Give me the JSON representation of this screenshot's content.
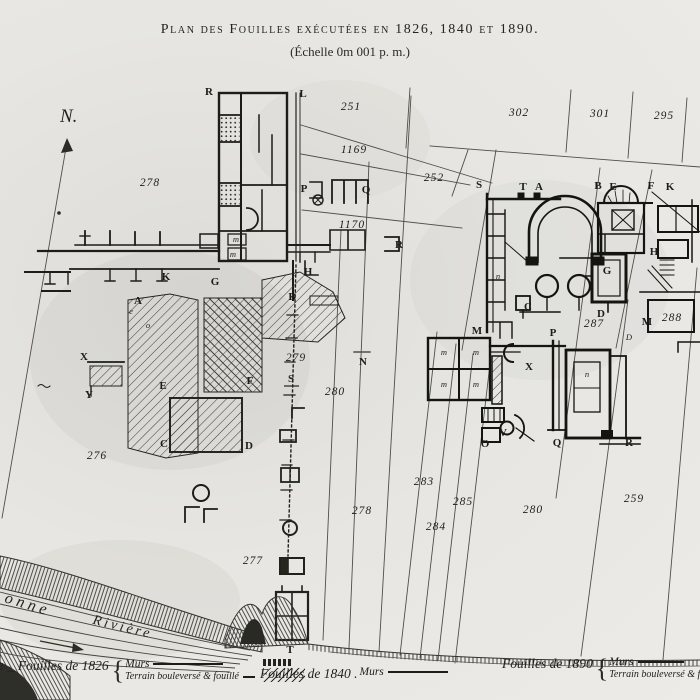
{
  "title": "Plan des Fouilles exécutées en 1826, 1840 et 1890.",
  "subtitle": "(Échelle 0m 001 p. m.)",
  "compass_label": "N.",
  "river": {
    "name_upper": "onne",
    "name_lower": "Rivière"
  },
  "legend": {
    "e1826": {
      "lead": "e _",
      "title": "Fouilles de 1826",
      "murs": "Murs",
      "terrain": "Terrain bouleversé & fouillé"
    },
    "e1840": {
      "title": "Fouilles de 1840 .",
      "murs": "Murs"
    },
    "e1890": {
      "title": "Fouilles de 1890",
      "murs": "Murs",
      "terrain": "Terrain bouleversé & fouillé"
    }
  },
  "colors": {
    "paper": "#e7e6e2",
    "ink": "#1c1c18",
    "parcel_line": "#4f4f4a"
  },
  "map_labels": [
    {
      "t": "278",
      "x": 150,
      "y": 183,
      "c": "n"
    },
    {
      "t": "251",
      "x": 351,
      "y": 107,
      "c": "n"
    },
    {
      "t": "1169",
      "x": 354,
      "y": 150,
      "c": "n"
    },
    {
      "t": "252",
      "x": 434,
      "y": 178,
      "c": "n"
    },
    {
      "t": "1170",
      "x": 352,
      "y": 225,
      "c": "n"
    },
    {
      "t": "302",
      "x": 519,
      "y": 113,
      "c": "n"
    },
    {
      "t": "301",
      "x": 600,
      "y": 114,
      "c": "n"
    },
    {
      "t": "295",
      "x": 664,
      "y": 116,
      "c": "n"
    },
    {
      "t": "279",
      "x": 296,
      "y": 358,
      "c": "n"
    },
    {
      "t": "280",
      "x": 335,
      "y": 392,
      "c": "n"
    },
    {
      "t": "276",
      "x": 97,
      "y": 456,
      "c": "n"
    },
    {
      "t": "277",
      "x": 253,
      "y": 561,
      "c": "n"
    },
    {
      "t": "278",
      "x": 362,
      "y": 511,
      "c": "n"
    },
    {
      "t": "283",
      "x": 424,
      "y": 482,
      "c": "n"
    },
    {
      "t": "285",
      "x": 463,
      "y": 502,
      "c": "n"
    },
    {
      "t": "284",
      "x": 436,
      "y": 527,
      "c": "n"
    },
    {
      "t": "280",
      "x": 533,
      "y": 510,
      "c": "n"
    },
    {
      "t": "259",
      "x": 634,
      "y": 499,
      "c": "n"
    },
    {
      "t": "287",
      "x": 594,
      "y": 324,
      "c": "n"
    },
    {
      "t": "288",
      "x": 672,
      "y": 318,
      "c": "n"
    },
    {
      "t": "R",
      "x": 209,
      "y": 92,
      "c": "L"
    },
    {
      "t": "L",
      "x": 303,
      "y": 94,
      "c": "L"
    },
    {
      "t": "P",
      "x": 304,
      "y": 189,
      "c": "L"
    },
    {
      "t": "Q",
      "x": 366,
      "y": 190,
      "c": "L"
    },
    {
      "t": "R",
      "x": 399,
      "y": 245,
      "c": "L"
    },
    {
      "t": "K",
      "x": 166,
      "y": 277,
      "c": "L"
    },
    {
      "t": "G",
      "x": 215,
      "y": 282,
      "c": "L"
    },
    {
      "t": "A",
      "x": 138,
      "y": 301,
      "c": "L"
    },
    {
      "t": "B",
      "x": 292,
      "y": 297,
      "c": "L"
    },
    {
      "t": "H",
      "x": 308,
      "y": 272,
      "c": "L"
    },
    {
      "t": "E",
      "x": 163,
      "y": 386,
      "c": "L"
    },
    {
      "t": "F",
      "x": 250,
      "y": 381,
      "c": "L"
    },
    {
      "t": "S",
      "x": 291,
      "y": 379,
      "c": "L"
    },
    {
      "t": "C",
      "x": 164,
      "y": 444,
      "c": "L"
    },
    {
      "t": "D",
      "x": 249,
      "y": 446,
      "c": "L"
    },
    {
      "t": "X",
      "x": 84,
      "y": 357,
      "c": "L"
    },
    {
      "t": "Y",
      "x": 89,
      "y": 395,
      "c": "L"
    },
    {
      "t": "T",
      "x": 290,
      "y": 650,
      "c": "L"
    },
    {
      "t": "S",
      "x": 479,
      "y": 185,
      "c": "L"
    },
    {
      "t": "T",
      "x": 523,
      "y": 187,
      "c": "L"
    },
    {
      "t": "A",
      "x": 539,
      "y": 187,
      "c": "L"
    },
    {
      "t": "B",
      "x": 598,
      "y": 186,
      "c": "L"
    },
    {
      "t": "E",
      "x": 613,
      "y": 187,
      "c": "L"
    },
    {
      "t": "F",
      "x": 651,
      "y": 186,
      "c": "L"
    },
    {
      "t": "K",
      "x": 670,
      "y": 187,
      "c": "L"
    },
    {
      "t": "G",
      "x": 607,
      "y": 271,
      "c": "L"
    },
    {
      "t": "H",
      "x": 654,
      "y": 252,
      "c": "L"
    },
    {
      "t": "C",
      "x": 528,
      "y": 307,
      "c": "L"
    },
    {
      "t": "D",
      "x": 601,
      "y": 314,
      "c": "L"
    },
    {
      "t": "M",
      "x": 647,
      "y": 322,
      "c": "L"
    },
    {
      "t": "M",
      "x": 477,
      "y": 331,
      "c": "L"
    },
    {
      "t": "P",
      "x": 553,
      "y": 333,
      "c": "L"
    },
    {
      "t": "X",
      "x": 529,
      "y": 367,
      "c": "L"
    },
    {
      "t": "O",
      "x": 485,
      "y": 444,
      "c": "L"
    },
    {
      "t": "V",
      "x": 503,
      "y": 433,
      "c": "L"
    },
    {
      "t": "Q",
      "x": 557,
      "y": 443,
      "c": "L"
    },
    {
      "t": "R",
      "x": 629,
      "y": 443,
      "c": "L"
    },
    {
      "t": "N",
      "x": 363,
      "y": 362,
      "c": "L"
    },
    {
      "t": "e",
      "x": 131,
      "y": 311,
      "c": "s"
    },
    {
      "t": "o",
      "x": 148,
      "y": 325,
      "c": "s"
    },
    {
      "t": "m",
      "x": 236,
      "y": 239,
      "c": "s"
    },
    {
      "t": "m",
      "x": 233,
      "y": 254,
      "c": "s"
    },
    {
      "t": "n",
      "x": 498,
      "y": 276,
      "c": "s"
    },
    {
      "t": "n",
      "x": 587,
      "y": 374,
      "c": "s"
    },
    {
      "t": "m",
      "x": 444,
      "y": 352,
      "c": "s"
    },
    {
      "t": "m",
      "x": 476,
      "y": 352,
      "c": "s"
    },
    {
      "t": "m",
      "x": 444,
      "y": 384,
      "c": "s"
    },
    {
      "t": "m",
      "x": 476,
      "y": 384,
      "c": "s"
    },
    {
      "t": "D",
      "x": 629,
      "y": 337,
      "c": "s"
    }
  ]
}
